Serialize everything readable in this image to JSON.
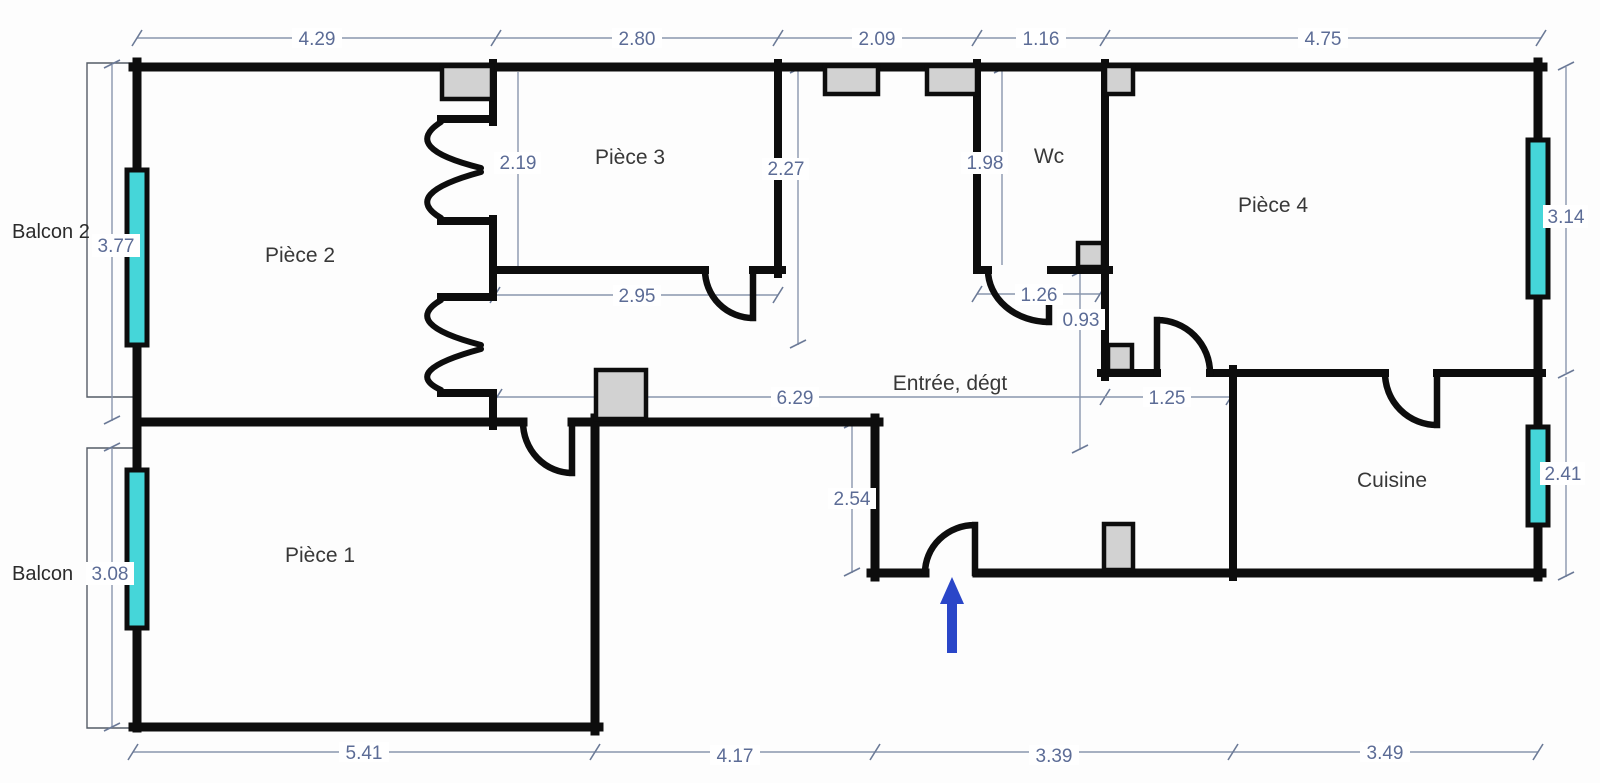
{
  "plan": {
    "type": "apartment-floor-plan",
    "units": "meters"
  },
  "rooms": {
    "piece1": "Pièce 1",
    "piece2": "Pièce 2",
    "piece3": "Pièce 3",
    "piece4": "Pièce 4",
    "wc": "Wc",
    "entree": "Entrée, dégt",
    "cuisine": "Cuisine",
    "balcon2": "Balcon 2",
    "balcon": "Balcon"
  },
  "dims": {
    "top": [
      "4.29",
      "2.80",
      "2.09",
      "1.16",
      "4.75"
    ],
    "bottom": [
      "5.41",
      "4.17",
      "3.39",
      "3.49"
    ],
    "left": [
      "3.77",
      "3.08"
    ],
    "right": [
      "3.14",
      "2.41"
    ],
    "interior": {
      "p3_left_height": "2.19",
      "p3_right_height": "2.27",
      "p3_width": "2.95",
      "wc_height": "1.98",
      "wc_width": "1.26",
      "wc_recess": "0.93",
      "hall_length": "6.29",
      "p4_door": "1.25",
      "entry_depth": "2.54"
    }
  },
  "colors": {
    "wall": "#0d0d0d",
    "window_glass": "#45d6d9",
    "gray_block": "#d2d2d2",
    "dim_line": "#8a96ad",
    "dim_text": "#5c6c96",
    "room_text": "#383838",
    "entrance_arrow": "#2a46c8",
    "background": "#ffffff"
  }
}
